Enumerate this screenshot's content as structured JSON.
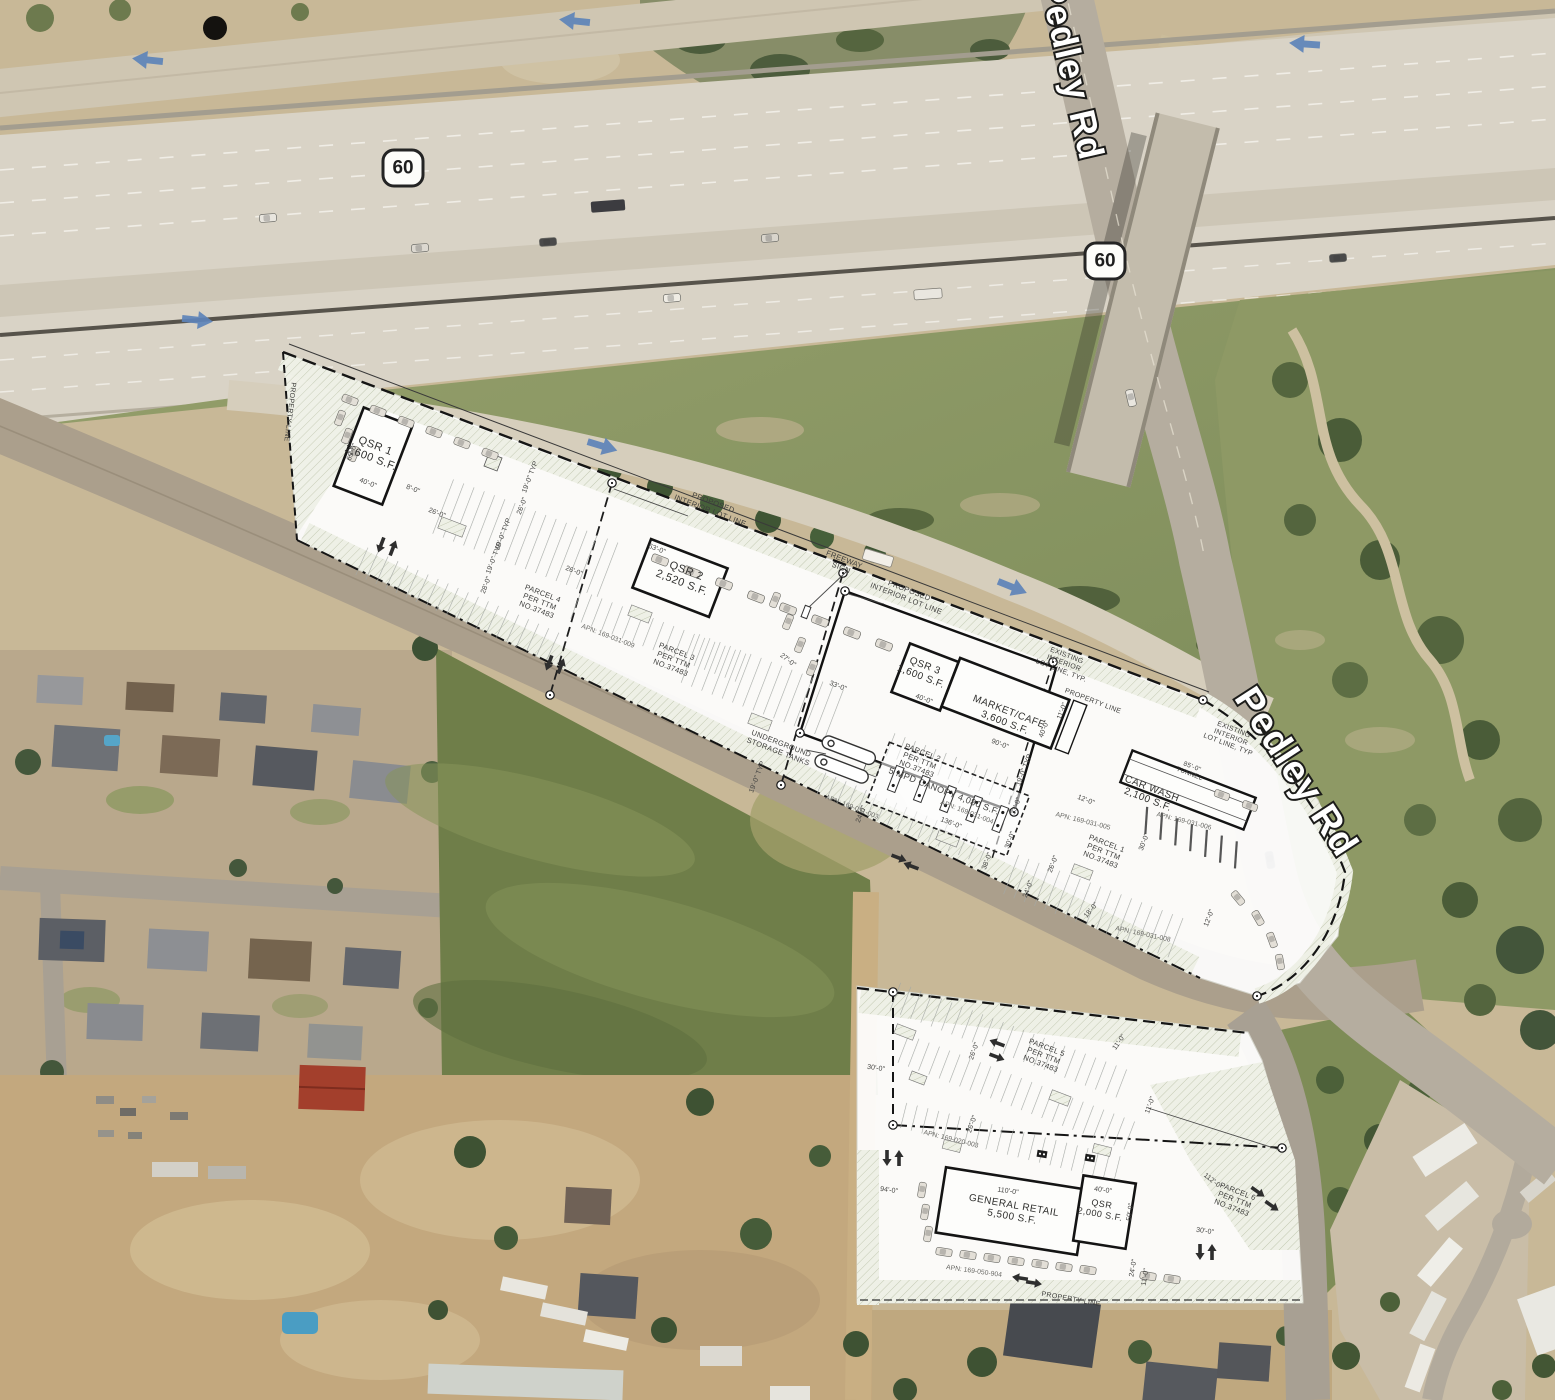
{
  "map": {
    "route_shield": "60",
    "road_labels": [
      {
        "text": "Pedley Rd"
      },
      {
        "text": "Pedley Rd"
      }
    ]
  },
  "upper_plan": {
    "buildings": [
      {
        "name": "QSR 1",
        "area": "2,600 S.F.",
        "x": 373,
        "y": 452,
        "r": 21,
        "fs": 11
      },
      {
        "name": "QSR 2",
        "area": "2,520 S.F.",
        "x": 684,
        "y": 577,
        "r": 21,
        "fs": 11
      },
      {
        "name": "QSR 3",
        "area": "1,600 S.F.",
        "x": 923,
        "y": 671,
        "r": 21,
        "fs": 10
      },
      {
        "name": "MARKET/CAFE",
        "area": "3,600 S.F.",
        "x": 1007,
        "y": 717,
        "r": 21,
        "fs": 10
      },
      {
        "name": "CAR WASH",
        "area": "2,100 S.F.",
        "x": 1150,
        "y": 794,
        "r": 21,
        "fs": 10
      }
    ],
    "annotations": [
      {
        "lines": [
          "85'-0\"",
          "TUNNEL"
        ],
        "x": 1191,
        "y": 770,
        "r": 21,
        "fs": 6.5
      },
      {
        "lines": [
          "5 MPD CANOPY 4,080 S.F."
        ],
        "x": 944,
        "y": 791,
        "r": 21,
        "fs": 9
      },
      {
        "lines": [
          "UNDERGROUND",
          "STORAGE TANKS"
        ],
        "x": 780,
        "y": 747,
        "r": 21,
        "fs": 7.5
      },
      {
        "lines": [
          "PROPOSED",
          "INTERIOR LOT LINE"
        ],
        "x": 712,
        "y": 506,
        "r": 21,
        "fs": 7.5
      },
      {
        "lines": [
          "PROPOSED",
          "INTERIOR LOT LINE"
        ],
        "x": 908,
        "y": 594,
        "r": 21,
        "fs": 7.5
      },
      {
        "lines": [
          "FREEWAY",
          "SIGN"
        ],
        "x": 843,
        "y": 563,
        "r": 21,
        "fs": 7.5
      },
      {
        "lines": [
          "EXISTING",
          "INTERIOR",
          "LOT LINE, TYP."
        ],
        "x": 1064,
        "y": 663,
        "r": 21,
        "fs": 7
      },
      {
        "lines": [
          "PROPERTY LINE"
        ],
        "x": 1093,
        "y": 701,
        "r": 21,
        "fs": 7
      },
      {
        "lines": [
          "EXISTING",
          "INTERIOR",
          "LOT LINE, TYP"
        ],
        "x": 1231,
        "y": 737,
        "r": 21,
        "fs": 7
      },
      {
        "lines": [
          "PROPERTY LINE"
        ],
        "x": 290,
        "y": 412,
        "r": 97,
        "fs": 7
      }
    ],
    "parcels": [
      {
        "lines": [
          "PARCEL 4",
          "PER TTM",
          "NO.37483"
        ],
        "x": 540,
        "y": 601,
        "r": 21,
        "fs": 7.5
      },
      {
        "lines": [
          "PARCEL 3",
          "PER TTM",
          "NO.37483"
        ],
        "x": 674,
        "y": 659,
        "r": 21,
        "fs": 7.5
      },
      {
        "lines": [
          "PARCEL 2",
          "PER TTM",
          "NO.37483"
        ],
        "x": 920,
        "y": 760,
        "r": 21,
        "fs": 7.5
      },
      {
        "lines": [
          "PARCEL 1",
          "PER TTM",
          "NO.37483"
        ],
        "x": 1104,
        "y": 851,
        "r": 21,
        "fs": 7.5
      }
    ],
    "apns": [
      {
        "t": "APN: 169-031-009",
        "x": 608,
        "y": 636,
        "r": 21,
        "fs": 6.8
      },
      {
        "t": "APN: 169-031-003",
        "x": 852,
        "y": 807,
        "r": 21,
        "fs": 6.8
      },
      {
        "t": "APN: 169-031-004",
        "x": 967,
        "y": 812,
        "r": 21,
        "fs": 6.8
      },
      {
        "t": "APN: 169-031-005",
        "x": 1083,
        "y": 821,
        "r": 14,
        "fs": 6.8
      },
      {
        "t": "APN: 169-031-006",
        "x": 1184,
        "y": 821,
        "r": 14,
        "fs": 6.8
      },
      {
        "t": "APN: 169-031-008",
        "x": 1143,
        "y": 934,
        "r": 12,
        "fs": 6.8
      }
    ],
    "dimensions": [
      {
        "t": "65'-0\"",
        "x": 352,
        "y": 452,
        "r": -69
      },
      {
        "t": "40'-0\"",
        "x": 368,
        "y": 483,
        "r": 21
      },
      {
        "t": "8'-0\"",
        "x": 413,
        "y": 489,
        "r": 21
      },
      {
        "t": "26'-0\"",
        "x": 437,
        "y": 513,
        "r": 21
      },
      {
        "t": "19'-0\" TYP",
        "x": 530,
        "y": 477,
        "r": -69
      },
      {
        "t": "26'-0\"",
        "x": 522,
        "y": 506,
        "r": -69
      },
      {
        "t": "19'-0\" TYP",
        "x": 503,
        "y": 534,
        "r": -69
      },
      {
        "t": "19'-0\" TYP",
        "x": 494,
        "y": 558,
        "r": -69
      },
      {
        "t": "28'-0\"",
        "x": 486,
        "y": 585,
        "r": -69
      },
      {
        "t": "26'-0\"",
        "x": 574,
        "y": 571,
        "r": 21
      },
      {
        "t": "63'-0\"",
        "x": 657,
        "y": 549,
        "r": 21
      },
      {
        "t": "27'-0\"",
        "x": 788,
        "y": 660,
        "r": 38
      },
      {
        "t": "33'-0\"",
        "x": 838,
        "y": 686,
        "r": 21
      },
      {
        "t": "40'-0\"",
        "x": 924,
        "y": 699,
        "r": 21
      },
      {
        "t": "90'-0\"",
        "x": 1000,
        "y": 744,
        "r": 21
      },
      {
        "t": "40'-0\"",
        "x": 1044,
        "y": 729,
        "r": -69
      },
      {
        "t": "11'-0\"",
        "x": 1062,
        "y": 711,
        "r": -69
      },
      {
        "t": "19'-0\" TYP",
        "x": 1024,
        "y": 770,
        "r": -69
      },
      {
        "t": "136'-0\"",
        "x": 951,
        "y": 823,
        "r": 21
      },
      {
        "t": "24'-0\"",
        "x": 861,
        "y": 814,
        "r": -69
      },
      {
        "t": "19'-0\" TYP",
        "x": 757,
        "y": 777,
        "r": -69
      },
      {
        "t": "33'-0\"",
        "x": 1016,
        "y": 806,
        "r": -69
      },
      {
        "t": "30'-0\"",
        "x": 1010,
        "y": 840,
        "r": -69
      },
      {
        "t": "38'-0\"",
        "x": 987,
        "y": 861,
        "r": -69
      },
      {
        "t": "26'-0\"",
        "x": 1053,
        "y": 864,
        "r": -69
      },
      {
        "t": "24'-0\"",
        "x": 1028,
        "y": 889,
        "r": -69
      },
      {
        "t": "30'-0\"",
        "x": 1144,
        "y": 842,
        "r": -69
      },
      {
        "t": "12'-0\"",
        "x": 1209,
        "y": 918,
        "r": -69
      },
      {
        "t": "12'-0\"",
        "x": 1086,
        "y": 800,
        "r": 21
      },
      {
        "t": "18'-0\"",
        "x": 1091,
        "y": 910,
        "r": -50
      }
    ]
  },
  "lower_plan": {
    "buildings": [
      {
        "name": "GENERAL RETAIL",
        "area": "5,500 S.F.",
        "x": 1013,
        "y": 1211,
        "r": 10,
        "fs": 10
      },
      {
        "name": "QSR",
        "area": "2,000 S.F.",
        "x": 1101,
        "y": 1209,
        "r": 10,
        "fs": 9
      }
    ],
    "parcels": [
      {
        "lines": [
          "PARCEL 5",
          "PER TTM",
          "NO.37483"
        ],
        "x": 1044,
        "y": 1055,
        "r": 21,
        "fs": 7.5
      },
      {
        "lines": [
          "PARCEL 6",
          "PER TTM",
          "NO.37483"
        ],
        "x": 1235,
        "y": 1199,
        "r": 21,
        "fs": 7.5
      }
    ],
    "apns": [
      {
        "t": "APN: 169-020-003",
        "x": 951,
        "y": 1139,
        "r": 14,
        "fs": 6.8
      },
      {
        "t": "APN: 169-050-904",
        "x": 974,
        "y": 1271,
        "r": 8,
        "fs": 6.8
      }
    ],
    "annotations": [
      {
        "lines": [
          "PROPERTY LINE"
        ],
        "x": 1071,
        "y": 1299,
        "r": 10,
        "fs": 7
      }
    ],
    "dimensions": [
      {
        "t": "30'-0\"",
        "x": 876,
        "y": 1068,
        "r": 8
      },
      {
        "t": "26'-0\"",
        "x": 974,
        "y": 1051,
        "r": -70
      },
      {
        "t": "26'-0\"",
        "x": 972,
        "y": 1124,
        "r": -70
      },
      {
        "t": "11'-0\"",
        "x": 1119,
        "y": 1042,
        "r": -55
      },
      {
        "t": "11'-0\"",
        "x": 1150,
        "y": 1105,
        "r": -70
      },
      {
        "t": "94'-0\"",
        "x": 889,
        "y": 1190,
        "r": 8
      },
      {
        "t": "110'-0\"",
        "x": 1008,
        "y": 1191,
        "r": 8
      },
      {
        "t": "40'-0\"",
        "x": 1103,
        "y": 1190,
        "r": 8
      },
      {
        "t": "50'-0\"",
        "x": 1130,
        "y": 1212,
        "r": -82
      },
      {
        "t": "112'-0\"",
        "x": 1213,
        "y": 1181,
        "r": 38
      },
      {
        "t": "30'-0\"",
        "x": 1205,
        "y": 1231,
        "r": 8
      },
      {
        "t": "24'-0\"",
        "x": 1133,
        "y": 1268,
        "r": -80
      },
      {
        "t": "11'-0\"",
        "x": 1145,
        "y": 1277,
        "r": -80
      }
    ]
  }
}
